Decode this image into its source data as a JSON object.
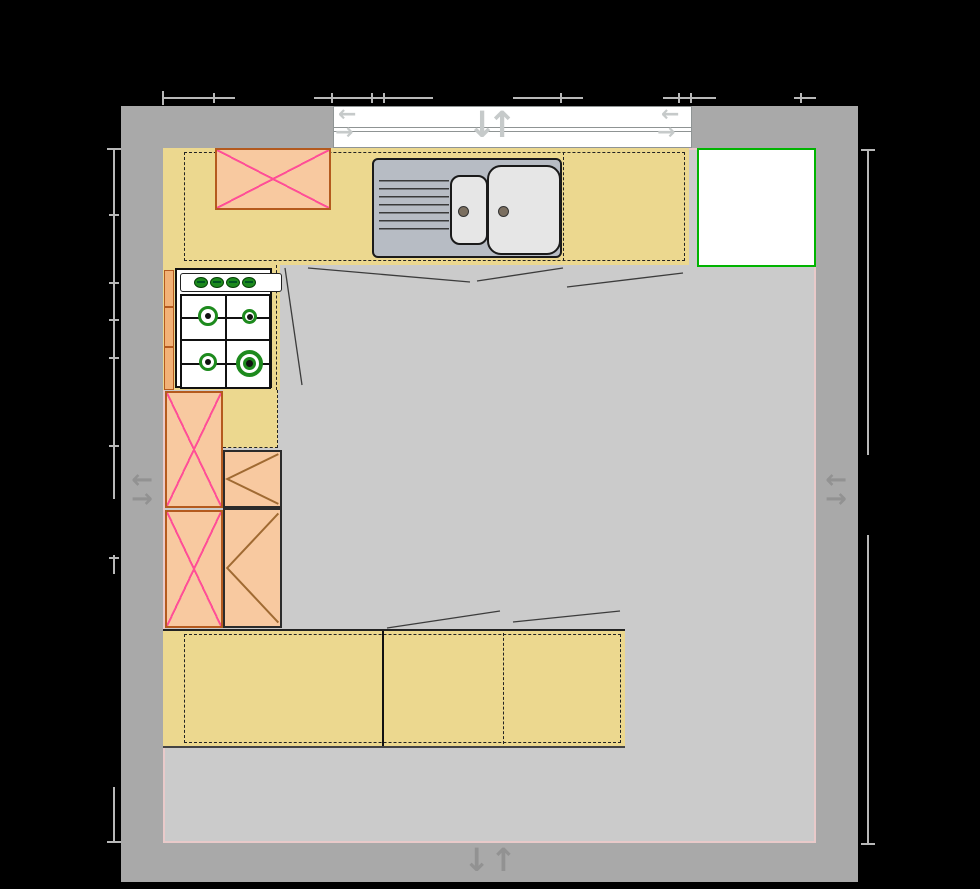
{
  "colors": {
    "background": "#000000",
    "wall": "#a9a9a9",
    "floor": "#cbcbcb",
    "floor_border": "#e9caca",
    "counter": "#ecd88f",
    "cabinet_fill": "#f8c9a0",
    "cabinet_border": "#b45a1e",
    "cross_line": "#ff4f97",
    "door_swing": "#a06a32",
    "dash_line": "#222222",
    "sink_body": "#b7bcc4",
    "sink_bowl": "#e6e6e6",
    "sink_outline": "#1a1a1a",
    "faucet_hole": "#7b6f60",
    "hob_bg": "#ffffff",
    "hob_outline": "#111111",
    "burner_green": "#1d8a1d",
    "fridge_border": "#00b400",
    "fridge_fill": "#ffffff",
    "window_fill": "#ffffff",
    "window_frame": "#8f9494",
    "window_arrow": "#c6caca",
    "wall_arrow": "#929292",
    "dimension": "#b8b8b8",
    "front_line": "#3c3c3c"
  },
  "glyphs": {
    "arrow_left": "←",
    "arrow_right": "→",
    "arrow_up": "↑",
    "arrow_down": "↓"
  },
  "hob": {
    "knob_count": 4,
    "burner_count": 4
  },
  "element_names": [
    "exterior-wall",
    "kitchen-floor",
    "window",
    "worktop",
    "wall-cabinet-x",
    "sink-double-bowl",
    "gas-hob",
    "tall-cabinet-x",
    "base-cabinet-door",
    "base-worktop",
    "fridge",
    "wall-opening-arrows",
    "dimension-lines"
  ]
}
